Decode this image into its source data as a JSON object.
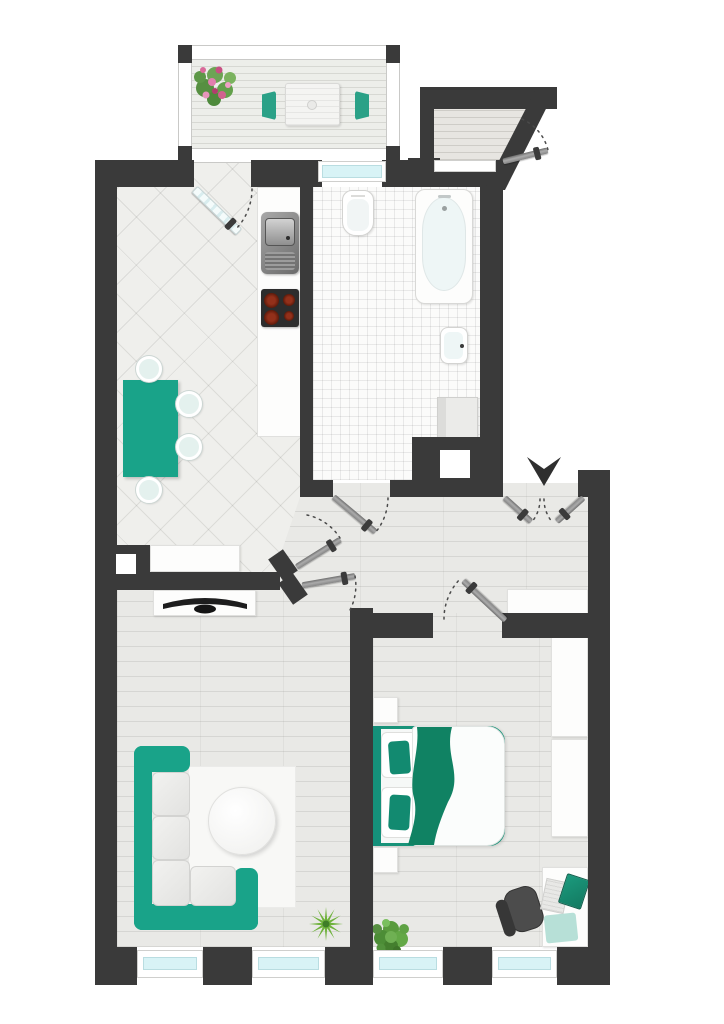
{
  "document": {
    "kind": "apartment-floor-plan",
    "view": "top-down",
    "text_labels": []
  },
  "colors": {
    "wall": "#3a3a3a",
    "accent": "#19a389",
    "accentDark": "#108263",
    "accentDeep": "#0e6e54",
    "glass": "#d8f3f6",
    "floor": "#e9e9e6",
    "white": "#ffffff",
    "arrow": "#2f2f2f",
    "chairGray": "#4c4c4c"
  },
  "rooms": [
    {
      "name": "balcony",
      "furniture": [
        "flower-planter",
        "patio-table",
        "patio-chair-left",
        "patio-chair-right",
        "railing"
      ]
    },
    {
      "name": "kitchen",
      "furniture": [
        "balcony-glass-door",
        "counter",
        "sink",
        "cooktop",
        "dining-table",
        "dining-chair x4",
        "sideboard"
      ]
    },
    {
      "name": "bathroom",
      "furniture": [
        "toilet",
        "bathtub",
        "wash-basin",
        "washing-machine",
        "window",
        "wall-niche"
      ]
    },
    {
      "name": "entrance-hall",
      "furniture": [
        "entry-double-door",
        "entry-direction-arrow",
        "hall-sideboard",
        "kitchen-door",
        "bathroom-door",
        "living-room-door",
        "bedroom-door",
        "vestibule-door"
      ]
    },
    {
      "name": "living-room",
      "furniture": [
        "tv-sideboard",
        "tv",
        "corner-sofa",
        "rug",
        "round-coffee-table",
        "spiky-plant",
        "window x2",
        "chimney-niche"
      ]
    },
    {
      "name": "bedroom",
      "furniture": [
        "double-bed",
        "nightstand x2",
        "wardrobe x2",
        "desk",
        "office-chair",
        "laptop",
        "notepad",
        "succulent-plant",
        "window x2"
      ]
    }
  ]
}
